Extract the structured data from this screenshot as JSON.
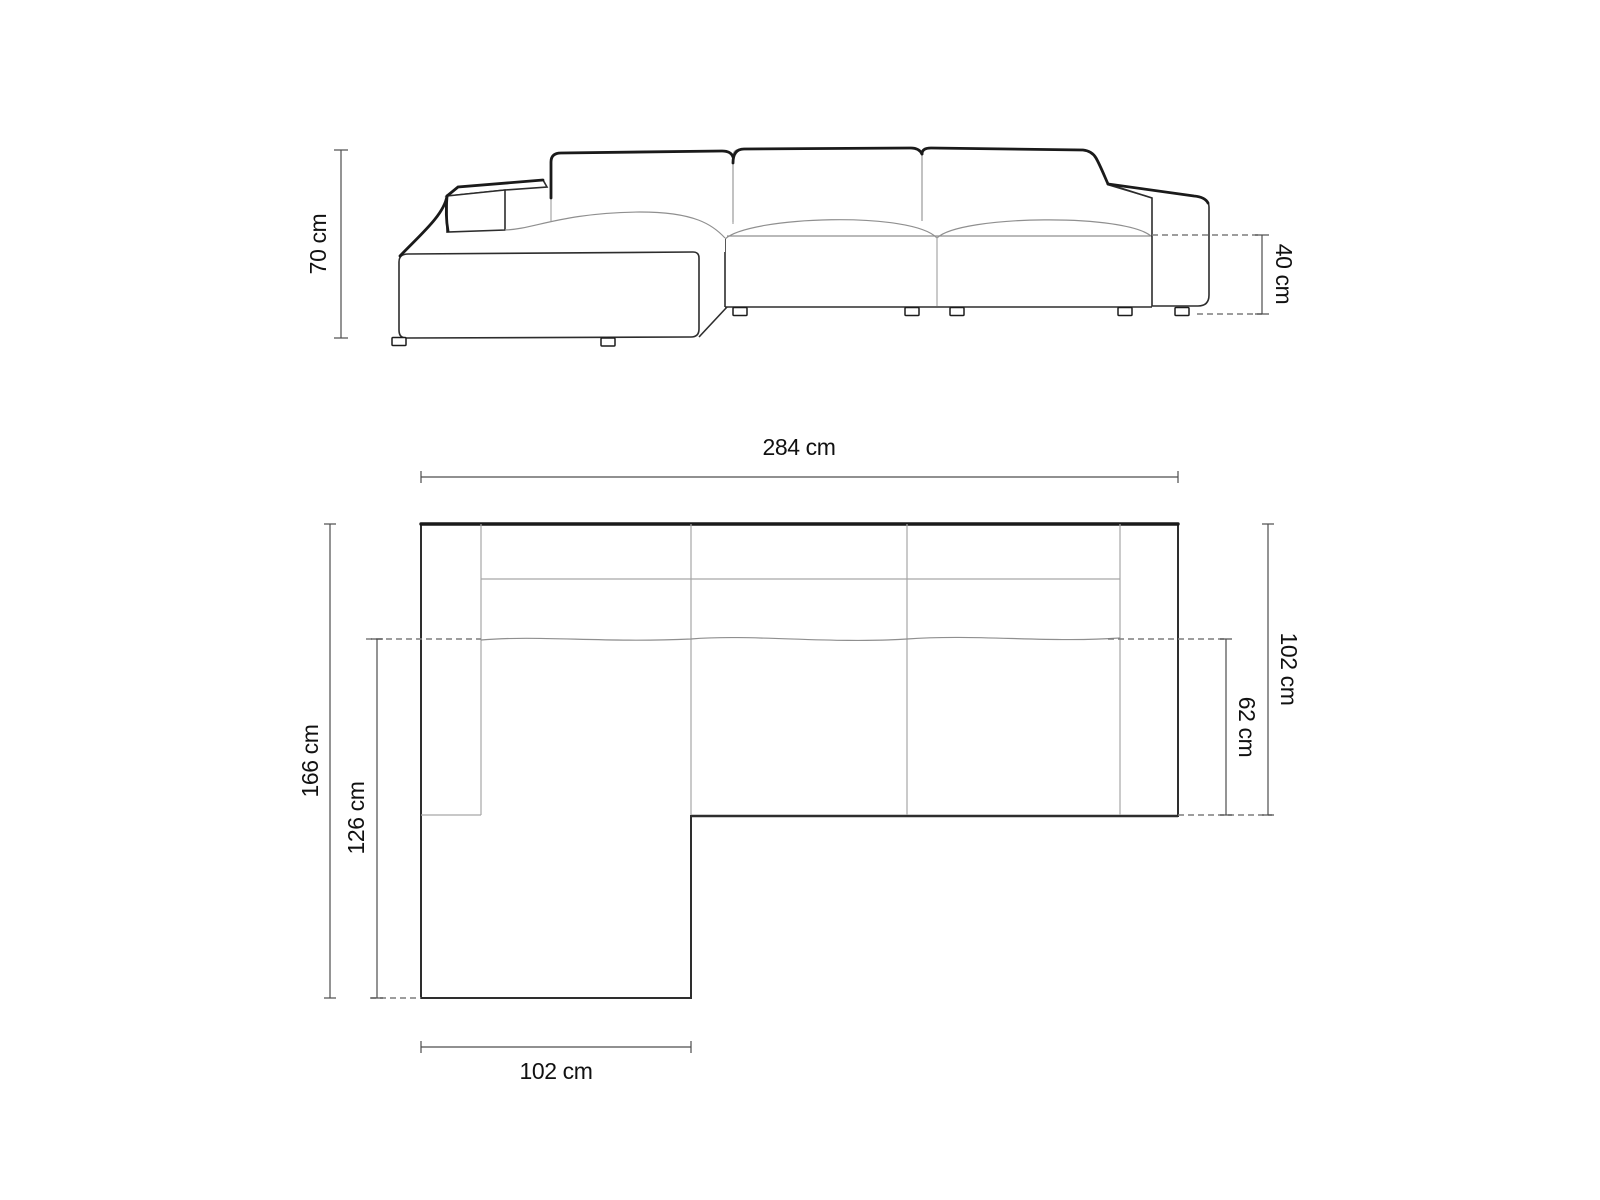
{
  "diagram_type": "sofa-dimension-drawing",
  "front_view": {
    "name": "front elevation of corner sofa with left chaise",
    "dims": {
      "height": "70 cm",
      "seat_height": "40 cm"
    }
  },
  "plan_view": {
    "name": "top plan of corner sofa with left chaise",
    "dims": {
      "total_width": "284 cm",
      "total_depth": "166 cm",
      "chaise_inner_depth": "126 cm",
      "right_depth": "102 cm",
      "seat_depth": "62 cm",
      "chaise_width": "102 cm"
    }
  },
  "colors": {
    "background": "#ffffff",
    "outline": "#2e2e2e",
    "outline_heavy": "#1a1a1a",
    "interior_line": "#a6a6a6",
    "dashed_line": "#7d7d7d",
    "dimension_line": "#4d4d4d",
    "text": "#111111"
  }
}
